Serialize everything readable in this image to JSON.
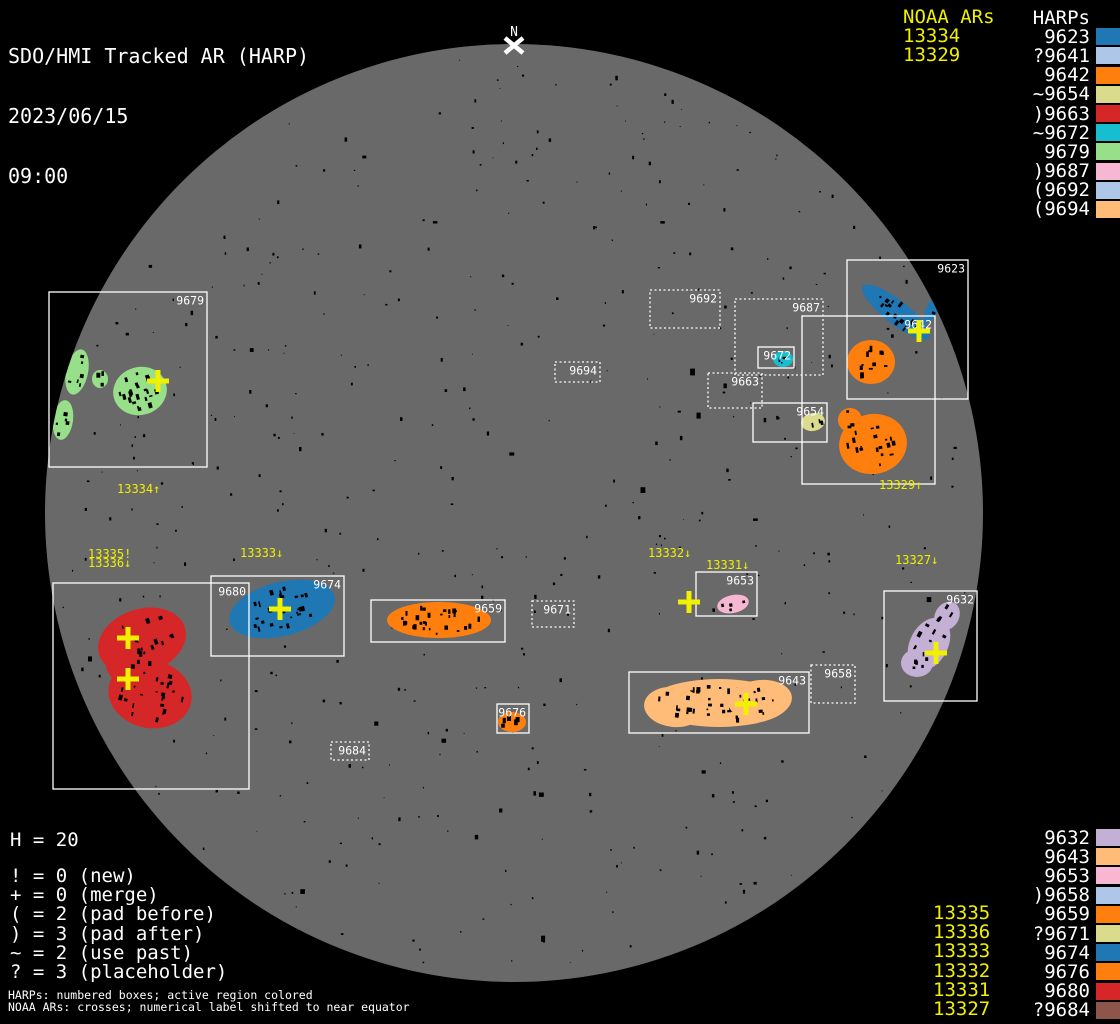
{
  "title": {
    "line1": "SDO/HMI Tracked AR (HARP)",
    "line2": "2023/06/15",
    "line3": "09:00"
  },
  "colors": {
    "background": "#000000",
    "disk": "#696969",
    "box_stroke": "#ffffff",
    "noaa_yellow": "#f0f000",
    "white": "#ffffff"
  },
  "north_marker": {
    "label": "N",
    "x": 514,
    "y": 45
  },
  "disk": {
    "cx": 514,
    "cy": 513,
    "r": 469
  },
  "panels": {
    "top_right": {
      "noaa_header": "NOAA ARs",
      "harp_header": "HARPs",
      "noaa_values": [
        "13334",
        "13329"
      ],
      "harps": [
        {
          "prefix": "",
          "num": "9623",
          "color": "#1f77b4"
        },
        {
          "prefix": "?",
          "num": "9641",
          "color": "#aec7e8"
        },
        {
          "prefix": "",
          "num": "9642",
          "color": "#ff7f0e"
        },
        {
          "prefix": "~",
          "num": "9654",
          "color": "#dbdb8d"
        },
        {
          "prefix": ")",
          "num": "9663",
          "color": "#d62728"
        },
        {
          "prefix": "~",
          "num": "9672",
          "color": "#17becf"
        },
        {
          "prefix": "",
          "num": "9679",
          "color": "#98df8a"
        },
        {
          "prefix": ")",
          "num": "9687",
          "color": "#f7b6d2"
        },
        {
          "prefix": "(",
          "num": "9692",
          "color": "#aec7e8"
        },
        {
          "prefix": "(",
          "num": "9694",
          "color": "#ffbb78"
        }
      ]
    },
    "bottom_right": {
      "harps": [
        {
          "prefix": "",
          "num": "9632",
          "color": "#c5b0d5"
        },
        {
          "prefix": "",
          "num": "9643",
          "color": "#ffbb78"
        },
        {
          "prefix": "",
          "num": "9653",
          "color": "#f7b6d2"
        },
        {
          "prefix": ")",
          "num": "9658",
          "color": "#aec7e8"
        },
        {
          "prefix": "",
          "num": "9659",
          "color": "#ff7f0e"
        },
        {
          "prefix": "?",
          "num": "9671",
          "color": "#dbdb8d"
        },
        {
          "prefix": "",
          "num": "9674",
          "color": "#1f77b4"
        },
        {
          "prefix": "",
          "num": "9676",
          "color": "#ff7f0e"
        },
        {
          "prefix": "",
          "num": "9680",
          "color": "#d62728"
        },
        {
          "prefix": "?",
          "num": "9684",
          "color": "#8c564b"
        }
      ],
      "noaa_values": [
        "13335",
        "13336",
        "13333",
        "13332",
        "13331",
        "13327"
      ]
    },
    "bottom_left": {
      "h_count": "H = 20",
      "legend": [
        "! = 0 (new)",
        "+ = 0 (merge)",
        "( = 2 (pad before)",
        ") = 3 (pad after)",
        "~ = 2 (use past)",
        "? = 3 (placeholder)"
      ],
      "footnotes": [
        "HARPs: numbered boxes; active region colored",
        "NOAA ARs: crosses; numerical label shifted to near equator"
      ]
    }
  },
  "harp_boxes": [
    {
      "id": "9679",
      "x": 49,
      "y": 292,
      "w": 158,
      "h": 175,
      "style": "solid"
    },
    {
      "id": "9680",
      "x": 53,
      "y": 583,
      "w": 196,
      "h": 206,
      "style": "solid"
    },
    {
      "id": "9674",
      "x": 211,
      "y": 576,
      "w": 133,
      "h": 80,
      "style": "solid"
    },
    {
      "id": "9659",
      "x": 371,
      "y": 600,
      "w": 134,
      "h": 42,
      "style": "solid"
    },
    {
      "id": "9671",
      "x": 532,
      "y": 601,
      "w": 42,
      "h": 26,
      "style": "dashed"
    },
    {
      "id": "9676",
      "x": 497,
      "y": 704,
      "w": 32,
      "h": 29,
      "style": "solid"
    },
    {
      "id": "9684",
      "x": 331,
      "y": 742,
      "w": 38,
      "h": 18,
      "style": "dashed"
    },
    {
      "id": "9694",
      "x": 555,
      "y": 362,
      "w": 45,
      "h": 20,
      "style": "dashed"
    },
    {
      "id": "9692",
      "x": 650,
      "y": 290,
      "w": 70,
      "h": 38,
      "style": "dashed"
    },
    {
      "id": "9687",
      "x": 735,
      "y": 299,
      "w": 88,
      "h": 76,
      "style": "dashed"
    },
    {
      "id": "9672",
      "x": 758,
      "y": 347,
      "w": 36,
      "h": 21,
      "style": "solid"
    },
    {
      "id": "9663",
      "x": 708,
      "y": 373,
      "w": 54,
      "h": 35,
      "style": "dashed"
    },
    {
      "id": "9654",
      "x": 753,
      "y": 403,
      "w": 74,
      "h": 39,
      "style": "solid"
    },
    {
      "id": "9642",
      "x": 802,
      "y": 316,
      "w": 133,
      "h": 168,
      "style": "solid"
    },
    {
      "id": "9623",
      "x": 847,
      "y": 260,
      "w": 121,
      "h": 139,
      "style": "solid"
    },
    {
      "id": "9653",
      "x": 696,
      "y": 572,
      "w": 61,
      "h": 44,
      "style": "solid"
    },
    {
      "id": "9643",
      "x": 629,
      "y": 672,
      "w": 180,
      "h": 61,
      "style": "solid"
    },
    {
      "id": "9658",
      "x": 811,
      "y": 665,
      "w": 44,
      "h": 38,
      "style": "dashed"
    },
    {
      "id": "9632",
      "x": 884,
      "y": 591,
      "w": 93,
      "h": 110,
      "style": "solid"
    }
  ],
  "active_regions": [
    {
      "harp": "9679",
      "color": "#98df8a",
      "shapes": [
        {
          "cx": 140,
          "cy": 391,
          "rx": 27,
          "ry": 24,
          "rot": -15,
          "spots": 24
        },
        {
          "cx": 77,
          "cy": 372,
          "rx": 11,
          "ry": 23,
          "rot": 12,
          "spots": 6
        },
        {
          "cx": 100,
          "cy": 379,
          "rx": 8,
          "ry": 9,
          "rot": 0,
          "spots": 3
        },
        {
          "cx": 63,
          "cy": 420,
          "rx": 10,
          "ry": 20,
          "rot": 8,
          "spots": 5
        }
      ]
    },
    {
      "harp": "9680",
      "color": "#d62728",
      "shapes": [
        {
          "cx": 142,
          "cy": 641,
          "rx": 45,
          "ry": 32,
          "rot": -18,
          "spots": 20
        },
        {
          "cx": 150,
          "cy": 694,
          "rx": 42,
          "ry": 34,
          "rot": 12,
          "spots": 24
        },
        {
          "cx": 132,
          "cy": 664,
          "rx": 26,
          "ry": 22,
          "rot": 0,
          "spots": 8
        }
      ]
    },
    {
      "harp": "9674",
      "color": "#1f77b4",
      "shapes": [
        {
          "cx": 282,
          "cy": 609,
          "rx": 54,
          "ry": 27,
          "rot": -14,
          "spots": 28
        }
      ]
    },
    {
      "harp": "9659",
      "color": "#ff7f0e",
      "shapes": [
        {
          "cx": 439,
          "cy": 620,
          "rx": 52,
          "ry": 18,
          "rot": 0,
          "spots": 28
        }
      ]
    },
    {
      "harp": "9676",
      "color": "#ff7f0e",
      "shapes": [
        {
          "cx": 512,
          "cy": 722,
          "rx": 14,
          "ry": 10,
          "rot": 0,
          "spots": 6
        }
      ]
    },
    {
      "harp": "9643",
      "color": "#ffbb78",
      "shapes": [
        {
          "cx": 719,
          "cy": 703,
          "rx": 70,
          "ry": 24,
          "rot": 0,
          "spots": 42
        },
        {
          "cx": 674,
          "cy": 707,
          "rx": 30,
          "ry": 20,
          "rot": 6,
          "spots": 10
        },
        {
          "cx": 760,
          "cy": 700,
          "rx": 32,
          "ry": 20,
          "rot": -6,
          "spots": 10
        }
      ]
    },
    {
      "harp": "9653",
      "color": "#f7b6d2",
      "shapes": [
        {
          "cx": 733,
          "cy": 604,
          "rx": 16,
          "ry": 9,
          "rot": -12,
          "spots": 4
        }
      ]
    },
    {
      "harp": "9632",
      "color": "#c5b0d5",
      "shapes": [
        {
          "cx": 929,
          "cy": 644,
          "rx": 19,
          "ry": 28,
          "rot": 28,
          "spots": 8
        },
        {
          "cx": 947,
          "cy": 616,
          "rx": 12,
          "ry": 15,
          "rot": 30,
          "spots": 4
        },
        {
          "cx": 917,
          "cy": 663,
          "rx": 16,
          "ry": 14,
          "rot": 0,
          "spots": 6
        }
      ]
    },
    {
      "harp": "9623",
      "color": "#1f77b4",
      "shapes": [
        {
          "cx": 896,
          "cy": 312,
          "rx": 42,
          "ry": 12,
          "rot": 38,
          "spots": 14
        },
        {
          "cx": 933,
          "cy": 308,
          "rx": 6,
          "ry": 17,
          "rot": 28,
          "spots": 2
        }
      ]
    },
    {
      "harp": "9642",
      "color": "#ff7f0e",
      "shapes": [
        {
          "cx": 871,
          "cy": 362,
          "rx": 24,
          "ry": 22,
          "rot": 0,
          "spots": 12
        },
        {
          "cx": 873,
          "cy": 444,
          "rx": 34,
          "ry": 30,
          "rot": -10,
          "spots": 18
        },
        {
          "cx": 850,
          "cy": 420,
          "rx": 12,
          "ry": 12,
          "rot": 0,
          "spots": 3
        }
      ]
    },
    {
      "harp": "9654",
      "color": "#dbdb8d",
      "shapes": [
        {
          "cx": 813,
          "cy": 422,
          "rx": 12,
          "ry": 9,
          "rot": -10,
          "spots": 3
        }
      ]
    },
    {
      "harp": "9672",
      "color": "#17becf",
      "shapes": [
        {
          "cx": 783,
          "cy": 359,
          "rx": 10,
          "ry": 8,
          "rot": 0,
          "spots": 3
        }
      ]
    }
  ],
  "noaa_crosses": [
    {
      "noaa": "13334",
      "x": 158,
      "y": 381
    },
    {
      "noaa": "13335",
      "x": 128,
      "y": 638
    },
    {
      "noaa": "13336",
      "x": 128,
      "y": 679
    },
    {
      "noaa": "13333",
      "x": 280,
      "y": 609
    },
    {
      "noaa": "13332",
      "x": 689,
      "y": 602
    },
    {
      "noaa": "13331",
      "x": 746,
      "y": 704
    },
    {
      "noaa": "13327",
      "x": 936,
      "y": 653
    },
    {
      "noaa": "13329",
      "x": 919,
      "y": 331
    }
  ],
  "noaa_disk_labels": [
    {
      "text": "13334↑",
      "x": 117,
      "y": 483
    },
    {
      "text": "13335!",
      "x": 88,
      "y": 548
    },
    {
      "text": "13336↓",
      "x": 88,
      "y": 557
    },
    {
      "text": "13333↓",
      "x": 240,
      "y": 547
    },
    {
      "text": "13332↓",
      "x": 648,
      "y": 547
    },
    {
      "text": "13331↓",
      "x": 706,
      "y": 559
    },
    {
      "text": "13327↓",
      "x": 895,
      "y": 554
    },
    {
      "text": "13329↑",
      "x": 879,
      "y": 479
    }
  ],
  "chart_data": {
    "type": "scatter",
    "title": "SDO/HMI Tracked AR (HARP) 2023/06/15 09:00",
    "notes": "Solar disk with tracked HARP boxes (white rectangles, dashed = padded/placeholder) and NOAA AR crosses (yellow)",
    "harp_total": 20,
    "flag_meanings": {
      "!": "0 (new)",
      "+": "0 (merge)",
      "(": "2 (pad before)",
      ")": "3 (pad after)",
      "~": "2 (use past)",
      "?": "3 (placeholder)"
    },
    "harps": [
      {
        "id": "9623",
        "flag": "",
        "color": "#1f77b4"
      },
      {
        "id": "9641",
        "flag": "?",
        "color": "#aec7e8"
      },
      {
        "id": "9642",
        "flag": "",
        "color": "#ff7f0e"
      },
      {
        "id": "9654",
        "flag": "~",
        "color": "#dbdb8d"
      },
      {
        "id": "9663",
        "flag": ")",
        "color": "#d62728"
      },
      {
        "id": "9672",
        "flag": "~",
        "color": "#17becf"
      },
      {
        "id": "9679",
        "flag": "",
        "color": "#98df8a"
      },
      {
        "id": "9687",
        "flag": ")",
        "color": "#f7b6d2"
      },
      {
        "id": "9692",
        "flag": "(",
        "color": "#aec7e8"
      },
      {
        "id": "9694",
        "flag": "(",
        "color": "#ffbb78"
      },
      {
        "id": "9632",
        "flag": "",
        "color": "#c5b0d5"
      },
      {
        "id": "9643",
        "flag": "",
        "color": "#ffbb78"
      },
      {
        "id": "9653",
        "flag": "",
        "color": "#f7b6d2"
      },
      {
        "id": "9658",
        "flag": ")",
        "color": "#aec7e8"
      },
      {
        "id": "9659",
        "flag": "",
        "color": "#ff7f0e"
      },
      {
        "id": "9671",
        "flag": "?",
        "color": "#dbdb8d"
      },
      {
        "id": "9674",
        "flag": "",
        "color": "#1f77b4"
      },
      {
        "id": "9676",
        "flag": "",
        "color": "#ff7f0e"
      },
      {
        "id": "9680",
        "flag": "",
        "color": "#d62728"
      },
      {
        "id": "9684",
        "flag": "?",
        "color": "#8c564b"
      }
    ],
    "noaa_ars": [
      "13334",
      "13329",
      "13335",
      "13336",
      "13333",
      "13332",
      "13331",
      "13327"
    ]
  }
}
